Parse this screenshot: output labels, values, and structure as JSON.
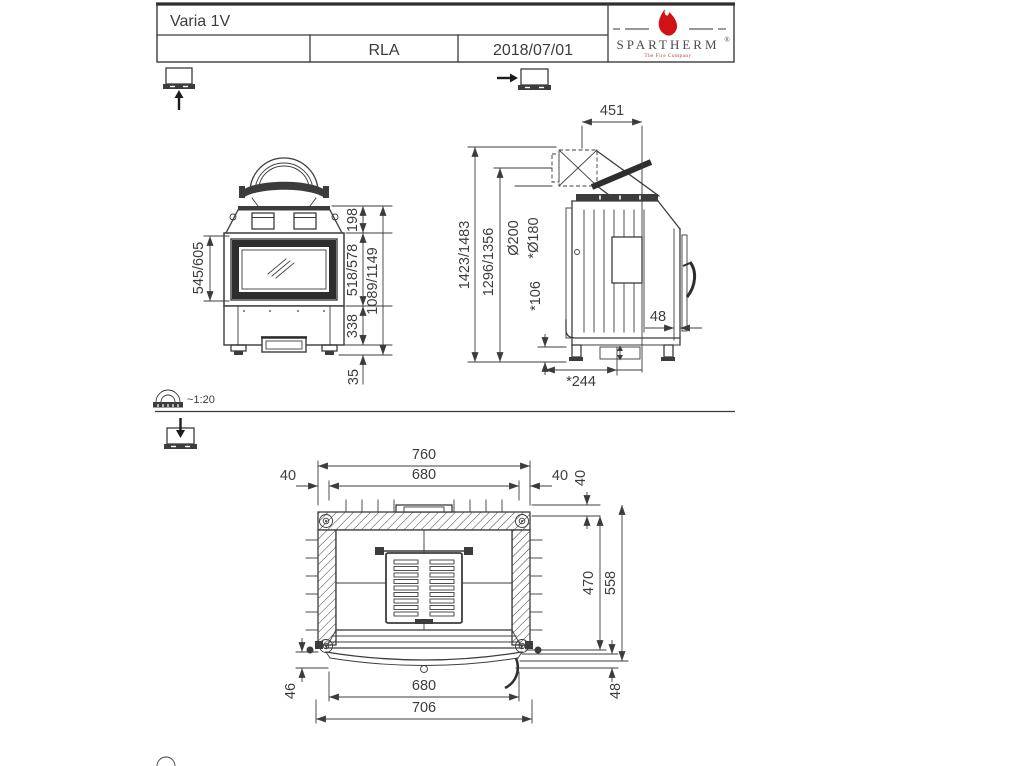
{
  "sheet": {
    "background": "#ffffff",
    "line_color": "#3c3c3c"
  },
  "title_block": {
    "model": "Varia 1V",
    "drawn_by": "RLA",
    "date": "2018/07/01"
  },
  "brand": {
    "name": "SPARTHERM",
    "registered_mark": "®",
    "tagline": "The Fire Company",
    "flame_color": "#d01217"
  },
  "scale_note": "~1:20",
  "icons": {
    "front_view_marker": "box-underline-with-up-arrow",
    "side_view_marker": "arrow-pointing-right-into-box",
    "top_view_marker": "down-arrow-into-box",
    "scale_icon": "tape-measure",
    "bottom_partial_icon": "tape-measure-partial"
  },
  "views": {
    "front": {
      "label": "front view",
      "dims": {
        "glass_height": "545/605",
        "hood_height": "198",
        "door_height": "518/578",
        "base_height": "338",
        "foot_height": "35",
        "overall_height": "1089/1149"
      }
    },
    "side": {
      "label": "side view",
      "dims": {
        "flue_depth": "451",
        "overall_height": "1423/1483",
        "flue_height": "1296/1356",
        "flue_diameter": "Ø200",
        "flue_diameter_reduced": "*Ø180",
        "clearance_bottom": "*106",
        "rear_gap": "48",
        "base_depth": "*244"
      }
    },
    "top": {
      "label": "top view",
      "dims": {
        "overall_width": "760",
        "opening_width": "680",
        "margin_left": "40",
        "margin_right": "40",
        "margin_top": "40",
        "body_depth": "470",
        "overall_depth": "558",
        "front_offset_left": "46",
        "door_width": "680",
        "front_width": "706",
        "front_offset_right": "48"
      }
    }
  }
}
